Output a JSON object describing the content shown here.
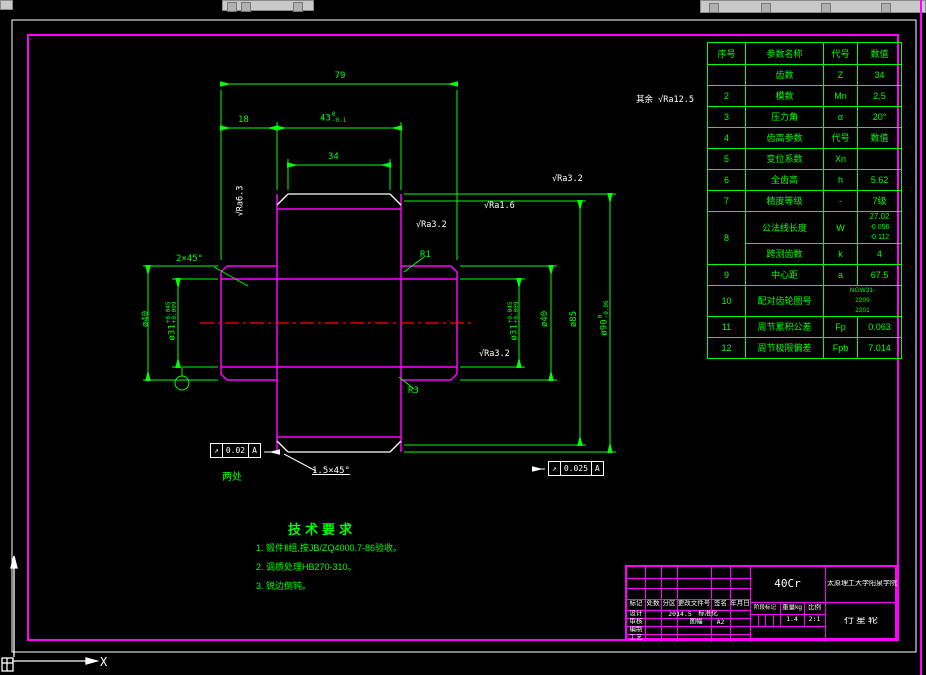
{
  "colors": {
    "background": "#000000",
    "dimension_green": "#00ff00",
    "outline_magenta": "#ff00ff",
    "detail_white": "#ffffff",
    "centerline_red": "#ff0000",
    "toolbar_gray": "#c9c9c9"
  },
  "icons": {
    "surface_finish_check": "√",
    "runout_arrow": "↗",
    "ucs": "ucs-axis-icon"
  },
  "param_table": {
    "header": [
      "序号",
      "参数名称",
      "代号",
      "数值"
    ],
    "rows": [
      {
        "no": "",
        "name": "齿数",
        "sym": "Z",
        "val": "34"
      },
      {
        "no": "2",
        "name": "模数",
        "sym": "Mn",
        "val": "2.5"
      },
      {
        "no": "3",
        "name": "压力角",
        "sym": "α",
        "val": "20°"
      },
      {
        "no": "4",
        "name": "齿高参数",
        "sym": "代号",
        "val": "数值"
      },
      {
        "no": "5",
        "name": "变位系数",
        "sym": "Xn",
        "val": ""
      },
      {
        "no": "6",
        "name": "全齿高",
        "sym": "h",
        "val": "5.62"
      },
      {
        "no": "7",
        "name": "精度等级",
        "sym": "-",
        "val": "7级"
      },
      {
        "no": "8",
        "name": "公法线长度",
        "sym": "W",
        "val": "27.02",
        "tol_upper": "-0.056",
        "tol_lower": "-0.112"
      },
      {
        "no": "",
        "name": "跨测齿数",
        "sym": "k",
        "val": "4"
      },
      {
        "no": "9",
        "name": "中心距",
        "sym": "a",
        "val": "67.5"
      },
      {
        "no": "10",
        "name": "配对齿轮图号",
        "sym": "",
        "val1": "NGW31-",
        "val2": "2209",
        "val3": "2201"
      },
      {
        "no": "11",
        "name": "周节累积公差",
        "sym": "Fp",
        "val": "0.063"
      },
      {
        "no": "12",
        "name": "周节极限偏差",
        "sym": "Fpb",
        "val": "7.014"
      }
    ]
  },
  "dims": {
    "total_width": "79",
    "hub_width": "18",
    "gear_width": "43",
    "gear_width_up": "0",
    "gear_width_low": "-0.1",
    "rim_width": "34",
    "chamfer_left": "2×45°",
    "hub_dia_left": "ø40",
    "hub_dia_right": "ø40",
    "bore_dia": "ø31",
    "bore_up": "+0.045",
    "bore_low": "+0.009",
    "bore_dia_right": "ø31",
    "bore_right_up": "+0.045",
    "bore_right_low": "+0.009",
    "pitch_dia": "ø85",
    "tip_dia": "ø90",
    "tip_up": "0",
    "tip_low": "-0.06",
    "fillet_r1": "R1",
    "fillet_r3": "R3",
    "chamfer_bottom": "1.5×45°",
    "two_places": "两处"
  },
  "finish": {
    "rest_label": "其余",
    "rest_value": "Ra12.5",
    "left_face": "Ra6.3",
    "flank": "Ra3.2",
    "top_right": "Ra1.6",
    "rim": "Ra3.2",
    "bore_right": "Ra3.2"
  },
  "gdt": {
    "f1": {
      "sym": "↗",
      "tol": "0.02",
      "datum": "A"
    },
    "f2": {
      "sym": "↗",
      "tol": "0.025",
      "datum": "A"
    }
  },
  "tech_req": {
    "title": "技术要求",
    "items": [
      "1. 锻件Ⅱ组,按JB/ZQ4000.7-86验收。",
      "2. 调质处理HB270-310。",
      "3. 锐边倒钝。"
    ]
  },
  "title_block": {
    "header": [
      "标记",
      "处数",
      "分区",
      "更改文件号",
      "签名",
      "年月日"
    ],
    "row_labels": [
      "设计",
      "审核",
      "编制",
      "工艺"
    ],
    "design_date": "2014.5",
    "standardization": "标准化",
    "sheet_label": "图幅",
    "sheet_size": "A2",
    "material": "40Cr",
    "stage_label": "阶段标记",
    "weight_label": "重量kg",
    "scale_label": "比例",
    "weight": "1.4",
    "scale": "2:1",
    "school": "太原理工大学阳泉学院",
    "part_name": "行星轮"
  },
  "ucs": {
    "x_label": "X"
  }
}
